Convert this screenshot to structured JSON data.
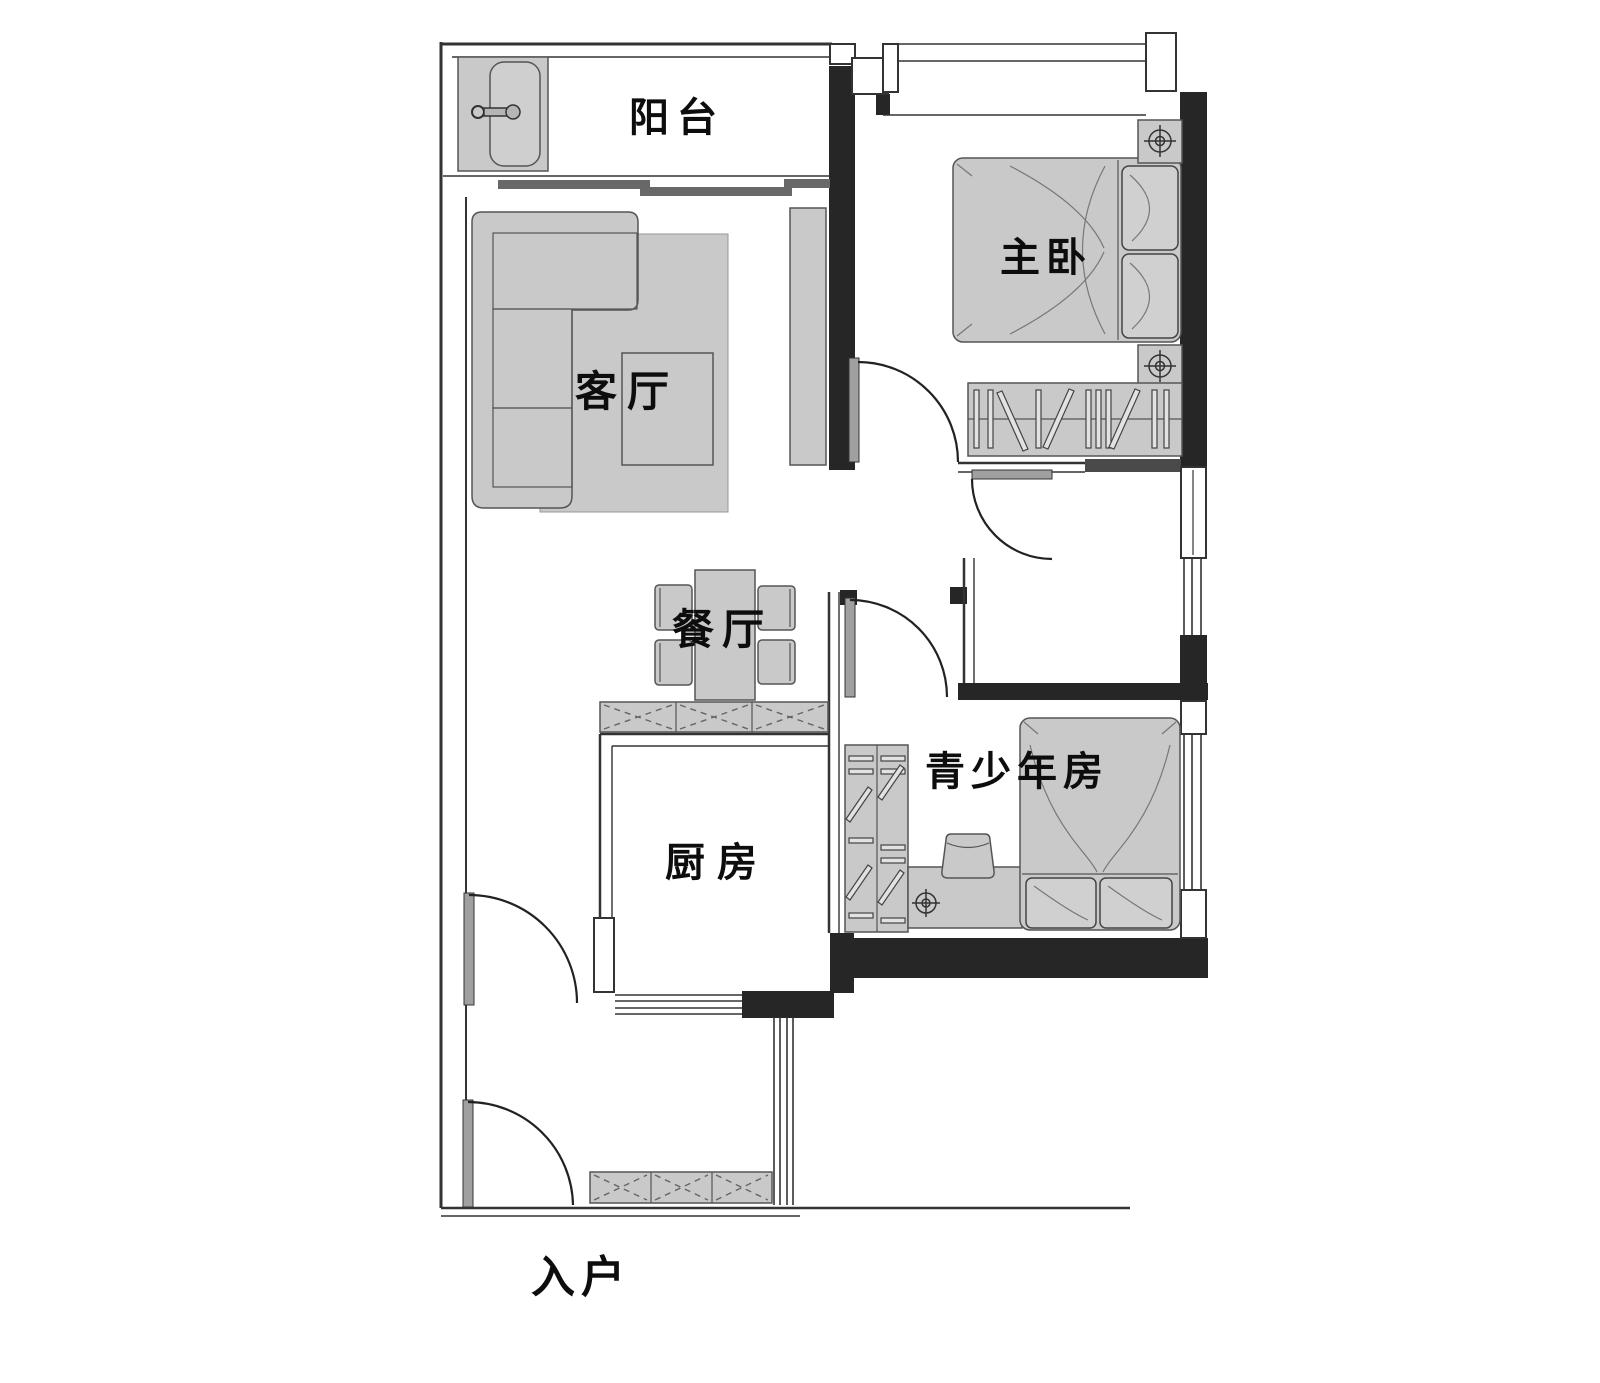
{
  "plan_title": "apartment-floor-plan",
  "rooms": {
    "balcony": {
      "label": "阳台"
    },
    "master_bedroom": {
      "label": "主卧"
    },
    "living_room": {
      "label": "客厅"
    },
    "dining_room": {
      "label": "餐厅"
    },
    "kitchen": {
      "label": "厨房"
    },
    "teen_room": {
      "label": "青少年房"
    },
    "entrance": {
      "label": "入户"
    }
  },
  "colors": {
    "background": "#ffffff",
    "wall_black": "#262626",
    "wall_line": "#333333",
    "furniture_fill": "#c9c9c9",
    "door_leaf": "#a0a0a0",
    "label_text": "#0d0d0d"
  }
}
